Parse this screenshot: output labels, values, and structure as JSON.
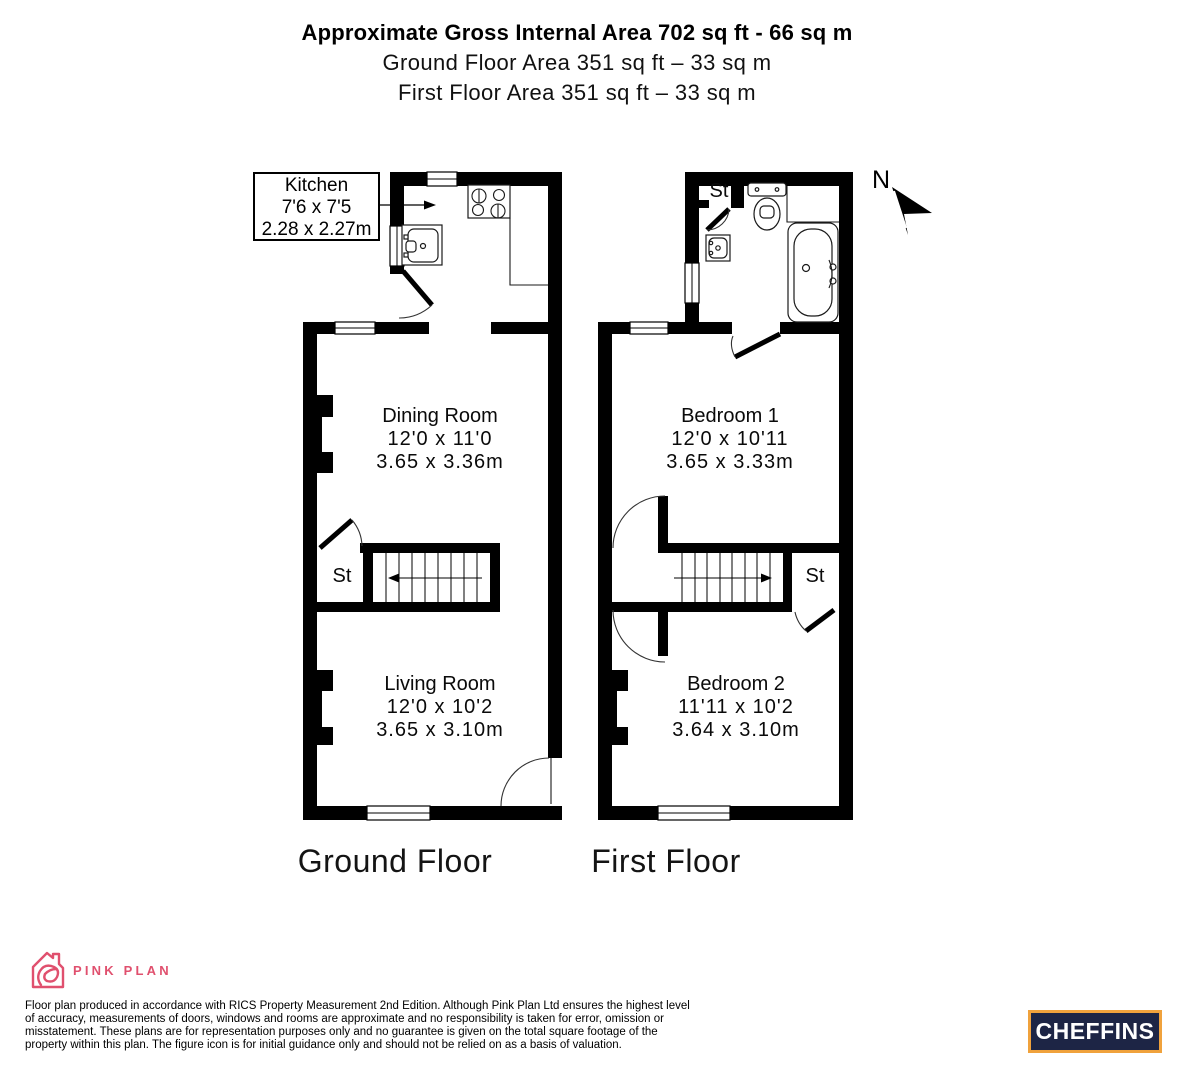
{
  "header": {
    "title": "Approximate Gross Internal Area 702 sq ft - 66 sq m",
    "subtitle_ground": "Ground Floor Area 351 sq ft – 33 sq m",
    "subtitle_first": "First Floor Area 351 sq ft – 33 sq m"
  },
  "compass": {
    "north_label": "N"
  },
  "kitchen_callout": {
    "name": "Kitchen",
    "imperial": "7'6 x 7'5",
    "metric": "2.28 x 2.27m"
  },
  "rooms": {
    "dining": {
      "name": "Dining Room",
      "imperial": "12'0 x 11'0",
      "metric": "3.65 x 3.36m"
    },
    "living": {
      "name": "Living Room",
      "imperial": "12'0 x 10'2",
      "metric": "3.65 x 3.10m"
    },
    "bedroom1": {
      "name": "Bedroom 1",
      "imperial": "12'0 x 10'11",
      "metric": "3.65 x 3.33m"
    },
    "bedroom2": {
      "name": "Bedroom 2",
      "imperial": "11'11 x 10'2",
      "metric": "3.64 x 3.10m"
    }
  },
  "labels": {
    "storage": "St"
  },
  "floors": {
    "ground": "Ground Floor",
    "first": "First Floor"
  },
  "branding": {
    "producer_name": "PINK PLAN",
    "agent_name": "CHEFFINS",
    "pink": "#e0506e",
    "navy": "#1d2545",
    "orange": "#f0a23c"
  },
  "disclaimer": "Floor plan produced in accordance with RICS Property Measurement 2nd Edition. Although Pink Plan Ltd ensures the highest level of accuracy, measurements of doors, windows and rooms are approximate and no responsibility is taken for error, omission or misstatement. These plans are for representation purposes only and no guarantee is given on the total square footage of the property within this plan. The figure icon is for initial guidance only and should not be relied on as a basis of valuation."
}
